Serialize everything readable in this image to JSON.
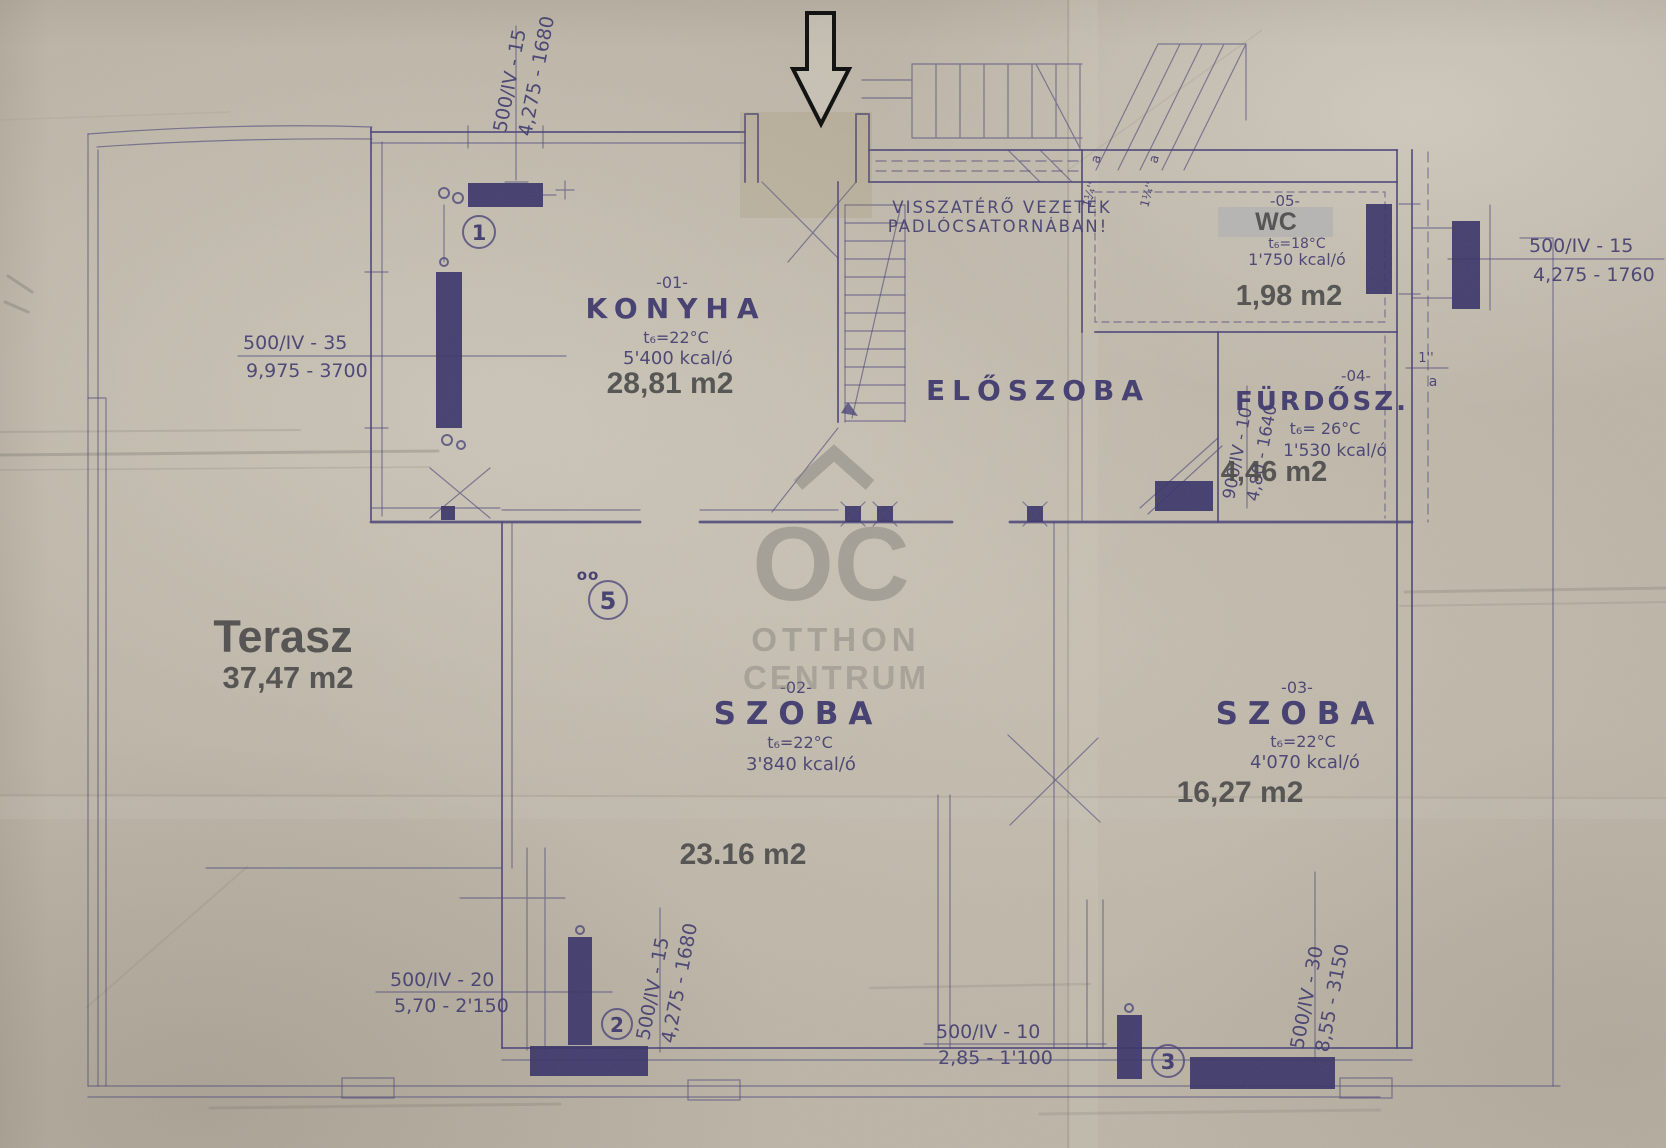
{
  "colors": {
    "paper": "#bcb5a7",
    "ink": "#4b4579",
    "radiator": "#3a3468",
    "printed_gray": "#4b4b4b",
    "watermark_gray": "#82807a",
    "arrow_black": "#0d0d0d",
    "wc_box_gray": "#b5b4b2"
  },
  "watermark": {
    "monogram": "OC",
    "word1": "OTTHON",
    "word2": "CENTRUM"
  },
  "rooms": {
    "konyha": {
      "no": "-01-",
      "name": "KONYHA",
      "temp": "t₆=22°C",
      "heat": "5'400 kcal/ó",
      "area": "28,81 m2"
    },
    "eloszoba": {
      "name": "ELŐSZOBA"
    },
    "wc": {
      "no": "-05-",
      "name": "WC",
      "temp": "t₆=18°C",
      "heat": "1'750 kcal/ó",
      "area": "1,98 m2"
    },
    "furdo": {
      "no": "-04-",
      "name": "FÜRDŐSZ.",
      "temp": "t₆= 26°C",
      "heat": "1'530 kcal/ó",
      "area": "4,46 m2"
    },
    "szoba2": {
      "no": "-02-",
      "name": "SZOBA",
      "temp": "t₆=22°C",
      "heat": "3'840 kcal/ó",
      "area": "23.16 m2"
    },
    "szoba3": {
      "no": "-03-",
      "name": "SZOBA",
      "temp": "t₆=22°C",
      "heat": "4'070 kcal/ó",
      "area": "16,27 m2"
    },
    "terasz": {
      "name": "Terasz",
      "area": "37,47 m2"
    }
  },
  "note": {
    "line1": "VISSZATÉRŐ VEZETÉK",
    "line2": "PADLÓCSATORNÁBAN!"
  },
  "dims": {
    "top_left": {
      "a": "500/IV - 15",
      "b": "4,275 - 1680"
    },
    "left": {
      "a": "500/IV - 35",
      "b": "9,975 - 3700"
    },
    "right": {
      "a": "500/IV - 15",
      "b": "4,275 - 1760"
    },
    "bath": {
      "a": "900/IV - 10",
      "b": "4,80 - 1640"
    },
    "bottom_left": {
      "a": "500/IV - 20",
      "b": "5,70 - 2'150"
    },
    "bottom_left_v": {
      "a": "500/IV - 15",
      "b": "4,275 - 1680"
    },
    "bottom_mid": {
      "a": "500/IV - 10",
      "b": "2,85 - 1'100"
    },
    "bottom_right_v": {
      "a": "500/IV - 30",
      "b": "8,55 - 3150"
    }
  },
  "markers": {
    "r1": "1",
    "r2": "2",
    "r3": "3",
    "r5": "5",
    "oo": "oo"
  },
  "pipes": {
    "size1": "1''",
    "size1a": "a",
    "size2": "1¼''",
    "size2a": "a"
  }
}
